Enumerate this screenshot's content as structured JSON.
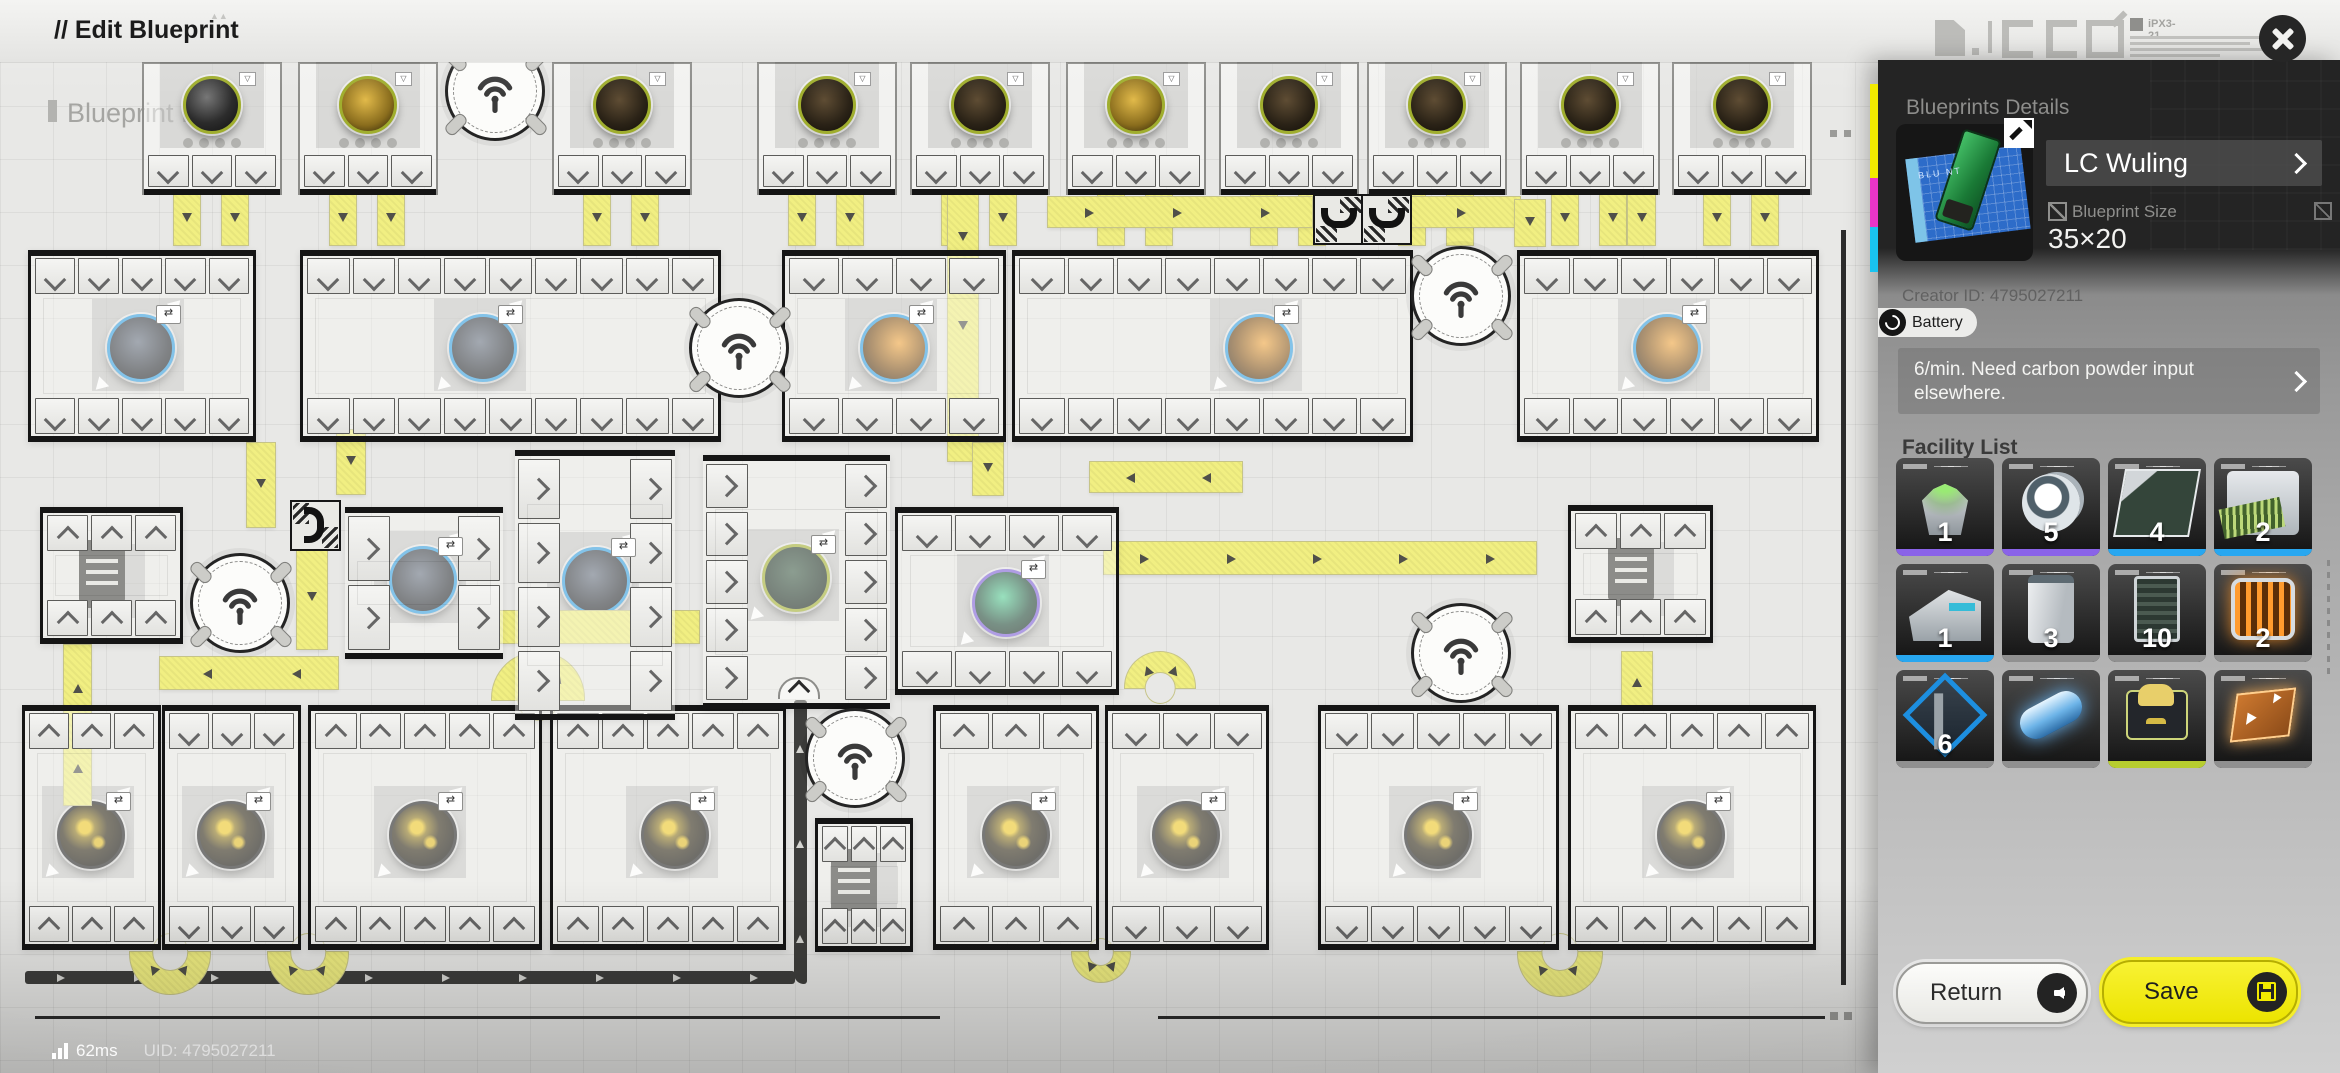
{
  "topbar": {
    "title": "// Edit Blueprint"
  },
  "status": {
    "ping": "62ms",
    "uid": "UID: 4795027211",
    "signal_icon": "signal-bars"
  },
  "decor": {
    "code": "iPX3-21"
  },
  "colors": {
    "save_yellow": "#ece400",
    "belt_yellow": "#f1ef82",
    "accent_blue": "#2f9de0",
    "accent_purple": "#7a5cd8",
    "accent_olive": "#a0ae2e",
    "strip_purple": "#8a63e8",
    "strip_blue": "#28a7f0",
    "strip_gray": "#909090",
    "strip_green": "#b7cd2f"
  },
  "canvas": {
    "watermark": "Blueprint Pre",
    "miners": [
      {
        "x": 210,
        "ore": "black"
      },
      {
        "x": 366,
        "ore": "gold"
      },
      {
        "x": 620,
        "ore": "brown"
      },
      {
        "x": 825,
        "ore": "brown"
      },
      {
        "x": 978,
        "ore": "brown"
      },
      {
        "x": 1134,
        "ore": "gold"
      },
      {
        "x": 1287,
        "ore": "brown"
      },
      {
        "x": 1435,
        "ore": "brown"
      },
      {
        "x": 1588,
        "ore": "brown"
      },
      {
        "x": 1740,
        "ore": "brown"
      }
    ],
    "buildings": [
      {
        "x": 28,
        "y": 250,
        "w": 222,
        "h": 192,
        "chev": "down",
        "machine": {
          "type": "ore-coal",
          "ring": "ring-blue",
          "mx": 138,
          "my": 345
        }
      },
      {
        "x": 300,
        "y": 250,
        "w": 415,
        "h": 192,
        "chev": "down",
        "machine": {
          "type": "ore-coal",
          "ring": "ring-blue",
          "mx": 480,
          "my": 345
        }
      },
      {
        "x": 782,
        "y": 250,
        "w": 218,
        "h": 192,
        "chev": "down",
        "machine": {
          "type": "ore-amber",
          "ring": "ring-blue",
          "mx": 891,
          "my": 345
        }
      },
      {
        "x": 1012,
        "y": 250,
        "w": 395,
        "h": 192,
        "chev": "down",
        "machine": {
          "type": "ore-amber",
          "ring": "ring-blue",
          "mx": 1256,
          "my": 345
        }
      },
      {
        "x": 1517,
        "y": 250,
        "w": 296,
        "h": 192,
        "chev": "down",
        "machine": {
          "type": "ore-amber",
          "ring": "ring-blue",
          "mx": 1664,
          "my": 345
        }
      },
      {
        "x": 895,
        "y": 507,
        "w": 218,
        "h": 188,
        "chev": "down",
        "machine": {
          "type": "ore-crystal",
          "ring": "ring-purple",
          "mx": 1003,
          "my": 600
        }
      },
      {
        "x": 22,
        "y": 705,
        "w": 133,
        "h": 245,
        "chev": "up",
        "machine": {
          "type": "ore-flower",
          "ring": "ring-dark",
          "mx": 88,
          "my": 832
        }
      },
      {
        "x": 162,
        "y": 705,
        "w": 133,
        "h": 245,
        "chev": "down",
        "machine": {
          "type": "ore-flower",
          "ring": "ring-dark",
          "mx": 228,
          "my": 832
        }
      },
      {
        "x": 308,
        "y": 705,
        "w": 228,
        "h": 245,
        "chev": "up",
        "machine": {
          "type": "ore-flower",
          "ring": "ring-dark",
          "mx": 420,
          "my": 832
        }
      },
      {
        "x": 550,
        "y": 705,
        "w": 230,
        "h": 245,
        "chev": "up",
        "machine": {
          "type": "ore-flower",
          "ring": "ring-dark",
          "mx": 672,
          "my": 832
        }
      },
      {
        "x": 933,
        "y": 705,
        "w": 160,
        "h": 245,
        "chev": "up",
        "machine": {
          "type": "ore-flower",
          "ring": "ring-dark",
          "mx": 1013,
          "my": 832
        }
      },
      {
        "x": 1105,
        "y": 705,
        "w": 158,
        "h": 245,
        "chev": "down",
        "machine": {
          "type": "ore-flower",
          "ring": "ring-dark",
          "mx": 1183,
          "my": 832
        }
      },
      {
        "x": 1318,
        "y": 705,
        "w": 235,
        "h": 245,
        "chev": "down",
        "machine": {
          "type": "ore-flower",
          "ring": "ring-dark",
          "mx": 1435,
          "my": 832
        }
      },
      {
        "x": 1568,
        "y": 705,
        "w": 242,
        "h": 245,
        "chev": "up",
        "machine": {
          "type": "ore-flower",
          "ring": "ring-dark",
          "mx": 1688,
          "my": 832
        }
      }
    ],
    "side_buildings": [
      {
        "x": 345,
        "y": 507,
        "w": 158,
        "h": 140,
        "ports": 2,
        "machine": {
          "type": "ore-coal",
          "ring": "ring-blue",
          "mx": 420,
          "my": 577
        }
      },
      {
        "x": 515,
        "y": 450,
        "w": 160,
        "h": 258,
        "ports": 4,
        "machine": {
          "type": "ore-coal",
          "ring": "ring-blue",
          "mx": 593,
          "my": 578
        }
      },
      {
        "x": 703,
        "y": 455,
        "w": 187,
        "h": 242,
        "ports": 5,
        "arch": true,
        "machine": {
          "type": "ore-green",
          "ring": "ring-olive",
          "mx": 793,
          "my": 575
        }
      }
    ],
    "storages": [
      {
        "x": 40,
        "y": 507,
        "w": 137,
        "h": 137
      },
      {
        "x": 815,
        "y": 818,
        "w": 92,
        "h": 134
      },
      {
        "x": 1568,
        "y": 505,
        "w": 139,
        "h": 138
      }
    ],
    "antennas": [
      {
        "cx": 492,
        "cy": 88
      },
      {
        "cx": 736,
        "cy": 345
      },
      {
        "cx": 1458,
        "cy": 293
      },
      {
        "cx": 237,
        "cy": 600
      },
      {
        "cx": 852,
        "cy": 755
      },
      {
        "cx": 1458,
        "cy": 650
      }
    ],
    "sorters": [
      {
        "x": 1313,
        "y": 194,
        "rot": 0
      },
      {
        "x": 1361,
        "y": 194,
        "rot": 0
      },
      {
        "x": 290,
        "y": 500,
        "rot": -90
      }
    ],
    "belts": [
      {
        "x": 948,
        "y": 193,
        "w": 30,
        "h": 268,
        "dir": "down"
      },
      {
        "x": 1048,
        "y": 197,
        "w": 264,
        "h": 30,
        "dir": "right"
      },
      {
        "x": 1408,
        "y": 197,
        "w": 112,
        "h": 30,
        "dir": "right"
      },
      {
        "x": 1515,
        "y": 200,
        "w": 30,
        "h": 46,
        "dir": "down"
      },
      {
        "x": 1628,
        "y": 193,
        "w": 27,
        "h": 52,
        "dir": "down"
      },
      {
        "x": 247,
        "y": 443,
        "w": 28,
        "h": 84,
        "dir": "down"
      },
      {
        "x": 337,
        "y": 430,
        "w": 28,
        "h": 64,
        "dir": "down"
      },
      {
        "x": 297,
        "y": 547,
        "w": 30,
        "h": 102,
        "dir": "down"
      },
      {
        "x": 160,
        "y": 657,
        "w": 178,
        "h": 32,
        "dir": "left"
      },
      {
        "x": 64,
        "y": 645,
        "w": 27,
        "h": 160,
        "dir": "up"
      },
      {
        "x": 493,
        "y": 611,
        "w": 206,
        "h": 32,
        "dir": "right"
      },
      {
        "x": 1090,
        "y": 462,
        "w": 152,
        "h": 30,
        "dir": "left"
      },
      {
        "x": 973,
        "y": 443,
        "w": 30,
        "h": 52,
        "dir": "down"
      },
      {
        "x": 1104,
        "y": 542,
        "w": 432,
        "h": 32,
        "dir": "right"
      },
      {
        "x": 1622,
        "y": 652,
        "w": 30,
        "h": 54,
        "dir": "up"
      }
    ],
    "dark_belts": [
      {
        "x": 25,
        "y": 971,
        "w": 770,
        "h": 13,
        "dir": "right"
      },
      {
        "x": 794,
        "y": 700,
        "w": 13,
        "h": 284,
        "dir": "up"
      }
    ],
    "uturns": [
      {
        "x": 130,
        "y": 952,
        "w": 80,
        "flip": false
      },
      {
        "x": 268,
        "y": 952,
        "w": 80,
        "flip": false
      },
      {
        "x": 1072,
        "y": 952,
        "w": 58,
        "flip": false
      },
      {
        "x": 1518,
        "y": 952,
        "w": 84,
        "flip": false
      },
      {
        "x": 492,
        "y": 652,
        "w": 92,
        "flip": true
      },
      {
        "x": 1125,
        "y": 652,
        "w": 70,
        "flip": true
      }
    ],
    "lines": [
      {
        "x": 35,
        "y": 1016,
        "w": 905,
        "h": 3
      },
      {
        "x": 1158,
        "y": 1016,
        "w": 667,
        "h": 3
      },
      {
        "x": 1841,
        "y": 230,
        "w": 5,
        "h": 755
      }
    ],
    "squares": [
      {
        "x": 1830,
        "y": 1012,
        "s": 8
      },
      {
        "x": 1844,
        "y": 1012,
        "s": 8
      },
      {
        "x": 1830,
        "y": 130,
        "s": 7
      },
      {
        "x": 1844,
        "y": 130,
        "s": 7
      }
    ]
  },
  "sidebar": {
    "header": "Blueprints Details",
    "name": "LC Wuling",
    "size_label": "Blueprint Size",
    "size_value": "35×20",
    "creator_id": "Creator ID: 4795027211",
    "badge": "Battery",
    "description": "6/min. Need carbon powder input elsewhere.",
    "thumb_text": "BLU  NT",
    "stripe": [
      {
        "c": "#f2ea00",
        "h": 94
      },
      {
        "c": "#e935c8",
        "h": 49
      },
      {
        "c": "#19c3f0",
        "h": 45
      }
    ],
    "facility_list": {
      "header": "Facility List",
      "items": [
        {
          "count": "1",
          "strip": "#8a63e8",
          "art": "fa1",
          "name": "extractor"
        },
        {
          "count": "5",
          "strip": "#8a63e8",
          "art": "fa2",
          "name": "refinery"
        },
        {
          "count": "4",
          "strip": "#28a7f0",
          "art": "fa3",
          "name": "assembler"
        },
        {
          "count": "2",
          "strip": "#28a7f0",
          "art": "fa4",
          "name": "printer"
        },
        {
          "count": "1",
          "strip": "#28a7f0",
          "art": "fa5",
          "name": "press"
        },
        {
          "count": "3",
          "strip": "#909090",
          "art": "fa6",
          "name": "cabinet"
        },
        {
          "count": "10",
          "strip": "#909090",
          "art": "fa7",
          "name": "silo"
        },
        {
          "count": "2",
          "strip": "#909090",
          "art": "fa8",
          "name": "heater"
        },
        {
          "count": "6",
          "strip": "#909090",
          "art": "fa9",
          "name": "pylon"
        },
        {
          "count": "",
          "strip": "#909090",
          "art": "fa10",
          "name": "capsule"
        },
        {
          "count": "",
          "strip": "#b7cd2f",
          "art": "fa11",
          "name": "packer"
        },
        {
          "count": "",
          "strip": "#909090",
          "art": "fa12",
          "name": "belt-plate"
        }
      ]
    },
    "buttons": {
      "return": "Return",
      "save": "Save"
    }
  }
}
